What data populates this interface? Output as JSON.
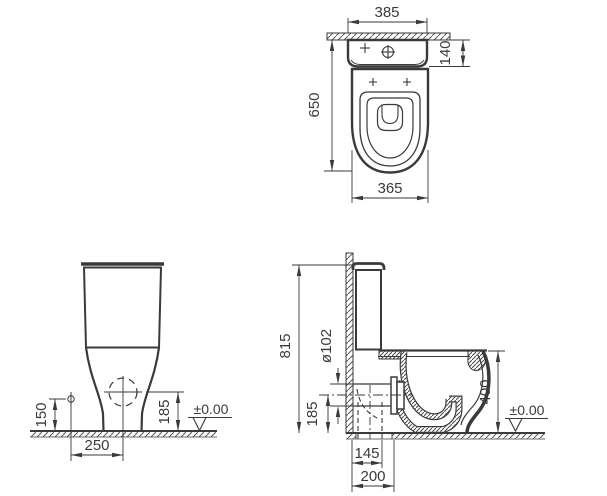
{
  "title": "Close-coupled WC pan — dimensional drawing",
  "colors": {
    "line": "#3a3a3a",
    "hatch": "#5a5a5a",
    "background": "#ffffff"
  },
  "views": {
    "plan": {
      "label": "top view",
      "dim_cistern_width": "385",
      "dim_wall_to_cistern_front": "140",
      "dim_wall_to_bowl_front": "650",
      "dim_bowl_width": "365"
    },
    "front": {
      "label": "front view",
      "dim_inlet_height": "150",
      "dim_outlet_center_height": "185",
      "dim_inlet_to_axis": "250",
      "floor_level": "±0.00"
    },
    "side": {
      "label": "side section view",
      "dim_total_height": "815",
      "dim_outlet_diameter": "ø102",
      "dim_outlet_axis_height": "185",
      "dim_rim_height": "400",
      "dim_wall_to_vertical_outlet": "145",
      "dim_wall_to_outlet_end": "200",
      "floor_level": "±0.00"
    }
  }
}
